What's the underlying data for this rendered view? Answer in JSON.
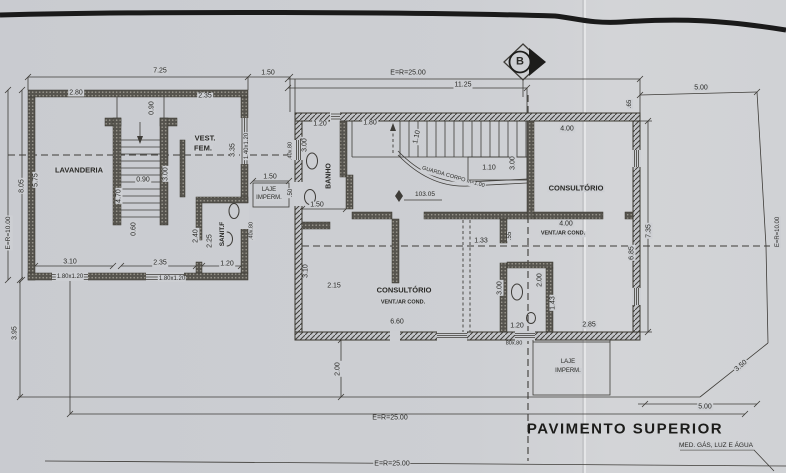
{
  "drawing": {
    "title": "PAVIMENTO SUPERIOR",
    "utility_note": "MED. GÁS, LUZ E ÁGUA",
    "section_marker": "B",
    "level": "103.05",
    "rooms": [
      "LAVANDERIA",
      "VEST. FEM.",
      "SANIT.F",
      "BANHO",
      "CONSULTÓRIO",
      "CONSULTÓRIO VENT./AR COND.",
      "VENT./AR COND.",
      "LAJE IMPERM."
    ],
    "site_dims": {
      "left": "E=R=10.00",
      "top": "E=R=25.00",
      "bottom": "E=R=25.00",
      "right": "E=R=10.00"
    }
  },
  "colors": {
    "paper": "#cdcfd3",
    "ink": "#3e3c38",
    "wall": "#56544e",
    "title_ink": "#1c1c1a"
  },
  "annotations": [
    {
      "n": "dim-lb-top-width",
      "t": "7.25",
      "x": 160,
      "y": 71
    },
    {
      "n": "dim-lb-top-gap",
      "t": "1.50",
      "x": 268,
      "y": 73
    },
    {
      "n": "dim-lb-wall-a",
      "t": "2.80",
      "x": 76,
      "y": 93
    },
    {
      "n": "dim-lb-wall-b",
      "t": "2.35",
      "x": 205,
      "y": 96
    },
    {
      "n": "dim-stair-width-top",
      "t": "0.90",
      "x": 152,
      "y": 108,
      "r": -90
    },
    {
      "n": "room-vest-fem-line1",
      "t": "VEST.",
      "x": 205,
      "y": 138,
      "b": 1,
      "s": 7.5
    },
    {
      "n": "room-vest-fem-line2",
      "t": "FEM.",
      "x": 203,
      "y": 148,
      "b": 1,
      "s": 7.5
    },
    {
      "n": "dim-vest-depth",
      "t": "3.35",
      "x": 233,
      "y": 150,
      "r": -90
    },
    {
      "n": "win-vest-size",
      "t": "1.40x1.20",
      "x": 247,
      "y": 146,
      "r": -90,
      "s": 6
    },
    {
      "n": "room-lavanderia",
      "t": "LAVANDERIA",
      "x": 79,
      "y": 170,
      "b": 1,
      "s": 7.5
    },
    {
      "n": "dim-site-left",
      "t": "E=R=10.00",
      "x": 9,
      "y": 233,
      "r": -90,
      "s": 6.5
    },
    {
      "n": "dim-lb-left-outer",
      "t": "8.05",
      "x": 22,
      "y": 186,
      "r": -90
    },
    {
      "n": "dim-lb-left-inner",
      "t": "5.75",
      "x": 36,
      "y": 180,
      "r": -90
    },
    {
      "n": "dim-stair-run",
      "t": "4.70",
      "x": 119,
      "y": 196,
      "r": -90
    },
    {
      "n": "dim-stair-mid",
      "t": "0.90",
      "x": 143,
      "y": 180
    },
    {
      "n": "dim-stair-right",
      "t": "3.00",
      "x": 166,
      "y": 174,
      "r": -90
    },
    {
      "n": "dim-stair-bottom",
      "t": "0.60",
      "x": 134,
      "y": 229,
      "r": -90
    },
    {
      "n": "dim-sanit-a",
      "t": "2.40",
      "x": 196,
      "y": 236,
      "r": -90
    },
    {
      "n": "dim-sanit-b",
      "t": "2.25",
      "x": 210,
      "y": 241,
      "r": -90
    },
    {
      "n": "room-sanit-f",
      "t": "SANIT.F",
      "x": 223,
      "y": 234,
      "r": -90,
      "b": 1,
      "s": 6.5
    },
    {
      "n": "dim-sanit-width",
      "t": "1.20",
      "x": 227,
      "y": 264
    },
    {
      "n": "dim-lb-bottom-a",
      "t": "3.10",
      "x": 70,
      "y": 262
    },
    {
      "n": "dim-lb-bottom-b",
      "t": "2.35",
      "x": 160,
      "y": 263
    },
    {
      "n": "win-lb-bottom-a",
      "t": "1.80x1.20",
      "x": 70,
      "y": 277,
      "s": 6
    },
    {
      "n": "win-lb-bottom-b",
      "t": "1.80x1.20",
      "x": 172,
      "y": 279,
      "s": 6
    },
    {
      "n": "dim-yard-left",
      "t": "3.95",
      "x": 15,
      "y": 333,
      "r": -90
    },
    {
      "n": "dim-laje-left-width",
      "t": "1.50",
      "x": 270,
      "y": 177
    },
    {
      "n": "laje-left-line1",
      "t": "LAJE",
      "x": 269,
      "y": 190,
      "s": 6
    },
    {
      "n": "laje-left-line2",
      "t": "IMPERM.",
      "x": 269,
      "y": 198,
      "s": 6
    },
    {
      "n": "dim-laje-50",
      "t": ".50",
      "x": 291,
      "y": 193,
      "r": -90,
      "s": 6
    },
    {
      "n": "win-40x80-a",
      "t": ".40x.80",
      "x": 252,
      "y": 231,
      "r": -90,
      "s": 5.5
    },
    {
      "n": "win-40x80-b",
      "t": ".40x.80",
      "x": 291,
      "y": 151,
      "r": -90,
      "s": 5.5
    },
    {
      "n": "dim-site-top",
      "t": "E=R=25.00",
      "x": 408,
      "y": 73
    },
    {
      "n": "dim-top-1125",
      "t": "11.25",
      "x": 463,
      "y": 85
    },
    {
      "n": "dim-top-right-500",
      "t": "5.00",
      "x": 701,
      "y": 88
    },
    {
      "n": "dim-65",
      "t": ".65",
      "x": 630,
      "y": 104,
      "r": -90,
      "s": 6
    },
    {
      "n": "dim-rb-top-a",
      "t": "1.20",
      "x": 320,
      "y": 124
    },
    {
      "n": "dim-rb-top-b",
      "t": "1.80",
      "x": 370,
      "y": 123
    },
    {
      "n": "dim-stair-110-v",
      "t": "1.10",
      "x": 417,
      "y": 137,
      "r": -78
    },
    {
      "n": "dim-stair-110-h",
      "t": "1.10",
      "x": 489,
      "y": 168
    },
    {
      "n": "dim-rb-left-300",
      "t": "3.00",
      "x": 305,
      "y": 145,
      "r": -90
    },
    {
      "n": "dim-stair-300",
      "t": "3.00",
      "x": 513,
      "y": 163,
      "r": -90
    },
    {
      "n": "dim-consult-top-400",
      "t": "4.00",
      "x": 567,
      "y": 129
    },
    {
      "n": "room-consultorio-top",
      "t": "CONSULTÓRIO",
      "x": 576,
      "y": 188,
      "b": 1,
      "s": 7.5
    },
    {
      "n": "room-banho",
      "t": "BANHO",
      "x": 329,
      "y": 176,
      "r": -90,
      "b": 1,
      "s": 7
    },
    {
      "n": "note-guarda-corpo",
      "t": "GUARDA CORPO  m=1.00",
      "x": 453,
      "y": 178,
      "r": 16,
      "s": 5.5
    },
    {
      "n": "dim-banho-width",
      "t": "1.50",
      "x": 317,
      "y": 205
    },
    {
      "n": "dim-133",
      "t": "1.33",
      "x": 481,
      "y": 241
    },
    {
      "n": "dim-55",
      "t": ".55",
      "x": 510,
      "y": 236,
      "r": -90,
      "s": 6
    },
    {
      "n": "dim-vent-top-400",
      "t": "4.00",
      "x": 566,
      "y": 224
    },
    {
      "n": "room-vent-top",
      "t": "VENT./AR COND.",
      "x": 563,
      "y": 234,
      "b": 1,
      "s": 5.5
    },
    {
      "n": "dim-wc-300",
      "t": "3.00",
      "x": 500,
      "y": 288,
      "r": -90
    },
    {
      "n": "dim-wc-200",
      "t": "2.00",
      "x": 540,
      "y": 280,
      "r": -90
    },
    {
      "n": "dim-wc-143",
      "t": "1.43",
      "x": 553,
      "y": 303,
      "r": -90
    },
    {
      "n": "dim-consult2-215",
      "t": "2.15",
      "x": 334,
      "y": 286
    },
    {
      "n": "dim-consult2-left",
      "t": "3.10",
      "x": 306,
      "y": 271,
      "r": -90
    },
    {
      "n": "room-consultorio-bottom",
      "t": "CONSULTÓRIO",
      "x": 404,
      "y": 290,
      "b": 1,
      "s": 7.5
    },
    {
      "n": "room-vent-bottom",
      "t": "VENT./AR COND.",
      "x": 403,
      "y": 303,
      "b": 1,
      "s": 5.5
    },
    {
      "n": "dim-consult2-width",
      "t": "6.60",
      "x": 397,
      "y": 322
    },
    {
      "n": "dim-wc-door-120",
      "t": "1.20",
      "x": 517,
      "y": 326
    },
    {
      "n": "dim-right-wing-285",
      "t": "2.85",
      "x": 589,
      "y": 325
    },
    {
      "n": "win-80x80",
      "t": "80x.80",
      "x": 514,
      "y": 344,
      "s": 5.5
    },
    {
      "n": "dim-rb-right-outer",
      "t": "7.35",
      "x": 649,
      "y": 231,
      "r": -90
    },
    {
      "n": "dim-rb-right-inner",
      "t": "6.85",
      "x": 632,
      "y": 253,
      "r": -90
    },
    {
      "n": "laje-right-line1",
      "t": "LAJE",
      "x": 568,
      "y": 362,
      "s": 6
    },
    {
      "n": "laje-right-line2",
      "t": "IMPERM.",
      "x": 568,
      "y": 371,
      "s": 6
    },
    {
      "n": "dim-diag-350",
      "t": "3.50",
      "x": 741,
      "y": 366,
      "r": -40
    },
    {
      "n": "dim-bottom-500",
      "t": "5.00",
      "x": 705,
      "y": 407
    },
    {
      "n": "dim-yard-200",
      "t": "2.00",
      "x": 338,
      "y": 369,
      "r": -90
    },
    {
      "n": "dim-site-bottom-1",
      "t": "E=R=25.00",
      "x": 390,
      "y": 418
    },
    {
      "n": "dim-site-bottom-2",
      "t": "E=R=25.00",
      "x": 392,
      "y": 464
    },
    {
      "n": "dim-site-right",
      "t": "E=R=10.00",
      "x": 778,
      "y": 232,
      "r": -90,
      "s": 6
    }
  ]
}
